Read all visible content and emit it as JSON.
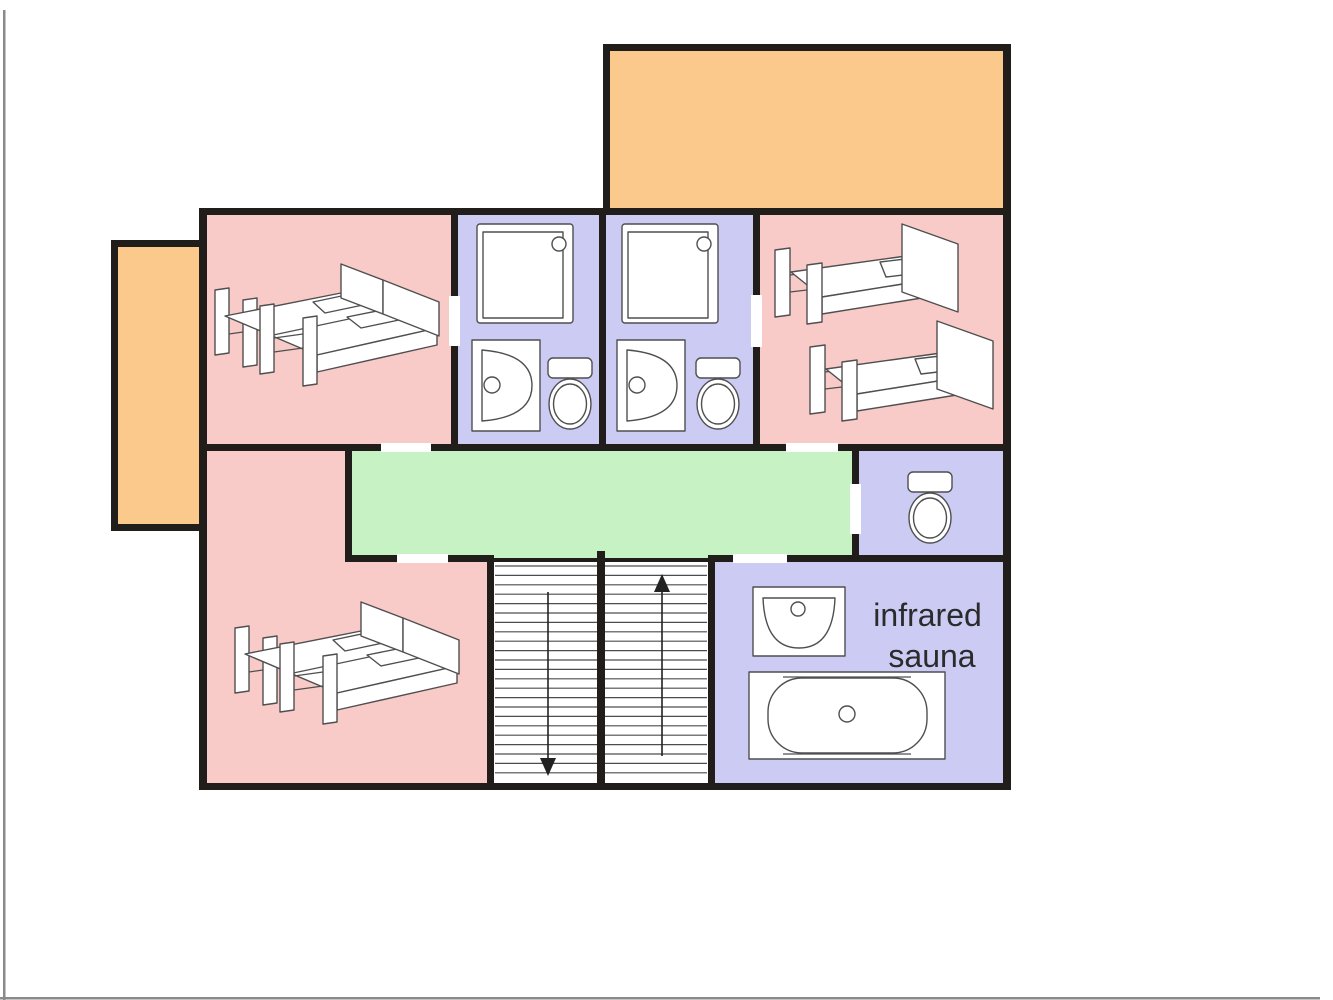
{
  "page": {
    "background": "#ffffff",
    "edge_color": "#8a8a8a"
  },
  "colors": {
    "bedroom": "#f9cbc8",
    "bathroom": "#cccbf4",
    "corridor": "#c7f2c3",
    "terrace": "#fac98b",
    "stairwell": "#ffffff",
    "wall": "#211d1a",
    "door_gap": "#ffffff",
    "fixture_outline": "#4f4f4f",
    "label_text": "#2b2b2b"
  },
  "label": {
    "line1": "infrared",
    "line2": "sauna"
  },
  "rooms": [
    {
      "id": "terrace-top",
      "type": "terrace",
      "color_key": "terrace",
      "fixtures": []
    },
    {
      "id": "terrace-left",
      "type": "terrace",
      "color_key": "terrace",
      "fixtures": []
    },
    {
      "id": "bedroom-top-left",
      "type": "bedroom",
      "color_key": "bedroom",
      "fixtures": [
        "double-bed-icon"
      ]
    },
    {
      "id": "bathroom-1",
      "type": "bathroom",
      "color_key": "bathroom",
      "fixtures": [
        "shower-icon",
        "washbasin-icon",
        "toilet-icon"
      ]
    },
    {
      "id": "bathroom-2",
      "type": "bathroom",
      "color_key": "bathroom",
      "fixtures": [
        "shower-icon",
        "washbasin-icon",
        "toilet-icon"
      ]
    },
    {
      "id": "bedroom-top-right",
      "type": "bedroom",
      "color_key": "bedroom",
      "fixtures": [
        "single-bed-icon",
        "single-bed-icon"
      ]
    },
    {
      "id": "corridor",
      "type": "corridor",
      "color_key": "corridor",
      "fixtures": []
    },
    {
      "id": "wc",
      "type": "toilet-room",
      "color_key": "bathroom",
      "fixtures": [
        "toilet-icon"
      ]
    },
    {
      "id": "bedroom-bottom-left",
      "type": "bedroom",
      "color_key": "bedroom",
      "fixtures": [
        "double-bed-icon"
      ]
    },
    {
      "id": "staircase",
      "type": "stairs",
      "color_key": "stairwell",
      "fixtures": []
    },
    {
      "id": "sauna-bathroom",
      "type": "bathroom",
      "color_key": "bathroom",
      "fixtures": [
        "washbasin-icon",
        "bathtub-icon"
      ],
      "label": "infrared sauna"
    }
  ],
  "stairs": {
    "tread_count": 23,
    "flights": [
      {
        "name": "left-flight",
        "arrow": "down"
      },
      {
        "name": "right-flight",
        "arrow": "up"
      }
    ]
  }
}
